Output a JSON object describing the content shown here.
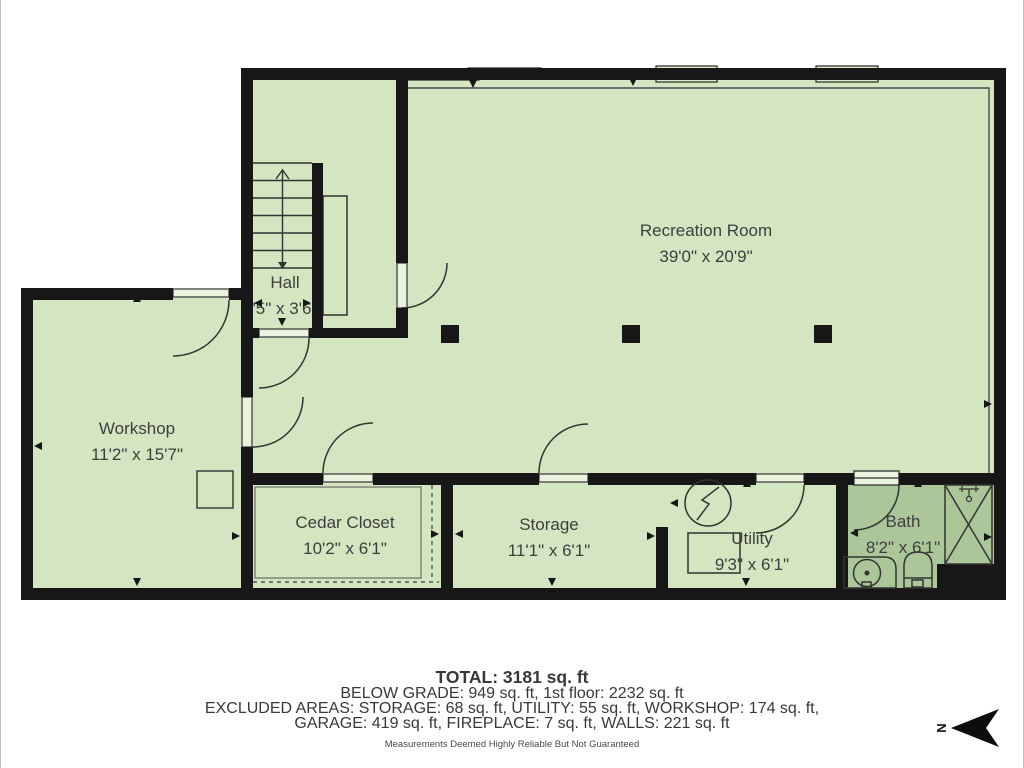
{
  "title": "Below grade floor plan",
  "rooms": [
    {
      "name": "Recreation Room",
      "dims": "39'0\" x 20'9\""
    },
    {
      "name": "Hall",
      "dims": "'5\" x 3'6\""
    },
    {
      "name": "Workshop",
      "dims": "11'2\" x 15'7\""
    },
    {
      "name": "Cedar Closet",
      "dims": "10'2\" x 6'1\""
    },
    {
      "name": "Storage",
      "dims": "11'1\" x 6'1\""
    },
    {
      "name": "Utility",
      "dims": "9'3\" x 6'1\""
    },
    {
      "name": "Bath",
      "dims": "8'2\" x 6'1\""
    }
  ],
  "summary": {
    "total": "TOTAL: 3181 sq. ft",
    "line2": "BELOW GRADE: 949 sq. ft, 1st floor: 2232 sq. ft",
    "line3": "EXCLUDED AREAS: STORAGE: 68 sq. ft, UTILITY: 55 sq. ft, WORKSHOP: 174 sq. ft,",
    "line4": "GARAGE: 419 sq. ft, FIREPLACE: 7 sq. ft, WALLS: 221 sq. ft",
    "disclaimer": "Measurements Deemed Highly Reliable But Not Guaranteed"
  },
  "compass": {
    "label": "N"
  },
  "colors": {
    "floor_light": "#d3e5c1",
    "floor_dark": "#abc79a",
    "wall": "#171717",
    "line": "#333333",
    "text": "#3e3e3e"
  }
}
